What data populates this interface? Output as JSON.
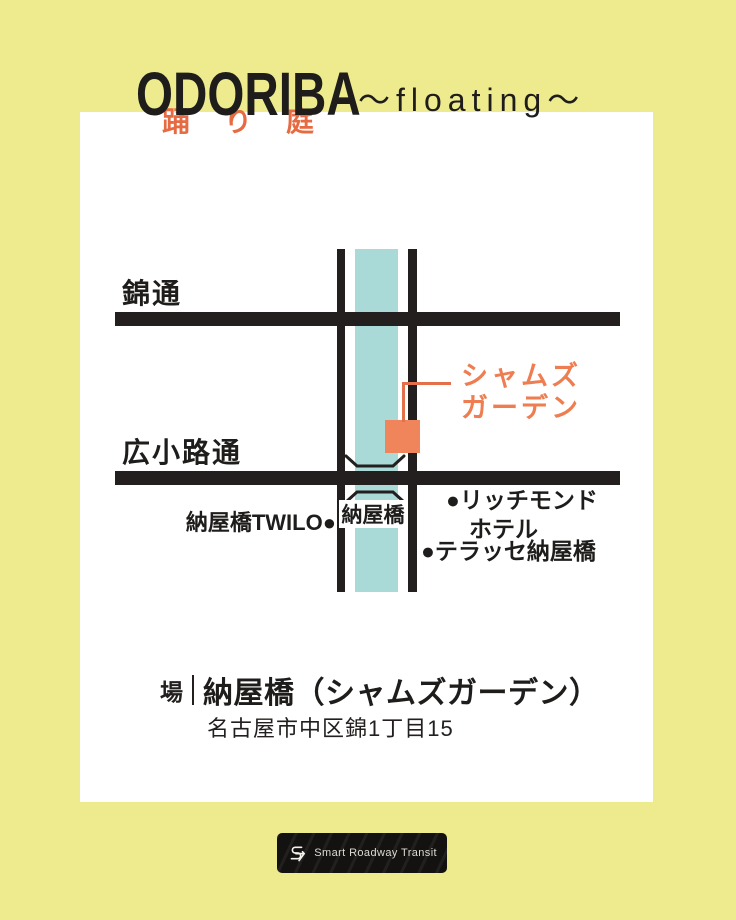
{
  "colors": {
    "background": "#edeb8d",
    "card": "#ffffff",
    "ink": "#221f1e",
    "accent_orange": "#ee7e51",
    "marker_orange": "#f0845a",
    "river_teal": "#aadad7"
  },
  "header": {
    "title_latin": "ODORIBA",
    "title_kana": "踊り庭",
    "subtitle": "〜floating〜"
  },
  "map": {
    "road_label_nishiki": "錦通",
    "road_label_hirokoji": "広小路通",
    "venue_label_line1": "シャムズ",
    "venue_label_line2": "ガーデン",
    "bridge_label": "納屋橋",
    "poi_twilo": "納屋橋TWILO●",
    "poi_richmond_line1": "●リッチモンド",
    "poi_richmond_line2": "ホテル",
    "poi_terrasse": "●テラッセ納屋橋"
  },
  "venue": {
    "prefix": "場",
    "name": "納屋橋（シャムズガーデン）",
    "address": "名古屋市中区錦1丁目15"
  },
  "footer": {
    "logo_text": "Smart Roadway Transit"
  }
}
